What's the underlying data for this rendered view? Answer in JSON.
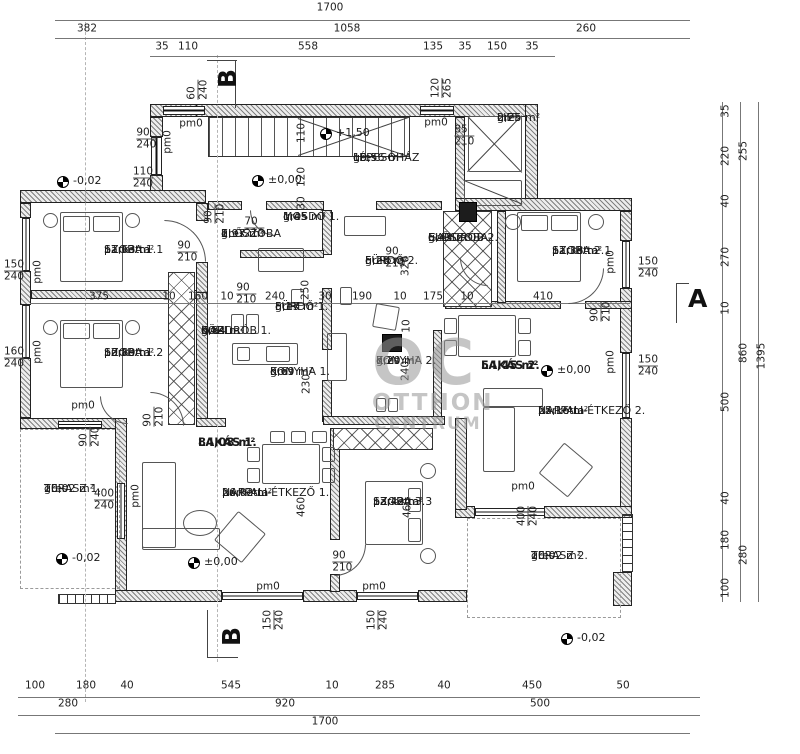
{
  "watermark": {
    "big": "OC",
    "line1": "OTTHON",
    "line2": "CENTRUM"
  },
  "rooms": [
    {
      "name": "LÉPCSŐHÁZ",
      "mat": "gres",
      "area": "19,56 m²",
      "x": 353,
      "y": 152
    },
    {
      "name": "LIFT",
      "mat": "gres",
      "area": "2,25 m²",
      "x": 497,
      "y": 112
    },
    {
      "name": "SZOBA 1.1",
      "mat": "parketta",
      "area": "11,63 m²",
      "x": 104,
      "y": 244
    },
    {
      "name": "SZOBA 1.2",
      "mat": "parketta",
      "area": "10,89 m²",
      "x": 104,
      "y": 347
    },
    {
      "name": "ELŐSZOBA",
      "n2": "1.",
      "mat": "gres",
      "area": "2,97 m²",
      "x": 221,
      "y": 228
    },
    {
      "name": "MOSDÓ 1.",
      "mat": "gres",
      "area": "1,45 m²",
      "x": 283,
      "y": 211
    },
    {
      "name": "FÜRDŐ 2.",
      "mat": "gres",
      "area": "5,28 m²",
      "x": 365,
      "y": 255
    },
    {
      "name": "ELŐSZOBA-",
      "n2": "GARDRÓB 2.",
      "mat": "gres",
      "area": "5,43 m²",
      "x": 428,
      "y": 232
    },
    {
      "name": "SZOBA 2.1",
      "mat": "parketta",
      "area": "11,38 m²",
      "x": 552,
      "y": 245
    },
    {
      "name": "KÖZL.-",
      "n2": "GARDRÓB 1.",
      "mat": "gres",
      "area": "6,84 m²",
      "x": 201,
      "y": 325
    },
    {
      "name": "FÜRDŐ 1.",
      "mat": "gres",
      "area": "5,17 m²",
      "x": 275,
      "y": 301
    },
    {
      "name": "KONYHA 1.",
      "mat": "gres",
      "area": "5,69 m²",
      "x": 270,
      "y": 366
    },
    {
      "name": "KONYHA 2.",
      "mat": "gres",
      "area": "7,20 m²",
      "x": 376,
      "y": 355
    },
    {
      "name": "LAKÁS 2.",
      "area": "54,45 m²",
      "bold": true,
      "x": 481,
      "y": 359
    },
    {
      "name": "NAPPALI-ÉTKEZŐ 2.",
      "mat": "parketta",
      "area": "25,16 m²",
      "x": 538,
      "y": 405
    },
    {
      "name": "TERASZ 1.",
      "mat": "gres",
      "area": "20,02 m²",
      "x": 44,
      "y": 483
    },
    {
      "name": "LAKÁS 1.",
      "area": "84,08 m²",
      "bold": true,
      "x": 198,
      "y": 436
    },
    {
      "name": "NAPPALI-ÉTKEZŐ 1.",
      "mat": "parketta",
      "area": "26,02 m²",
      "x": 222,
      "y": 487
    },
    {
      "name": "SZOBA 3.3",
      "mat": "parketta",
      "area": "13,42 m²",
      "x": 373,
      "y": 496
    },
    {
      "name": "TERASZ 2.",
      "mat": "gres",
      "area": "20,02 m²",
      "x": 531,
      "y": 550
    }
  ],
  "levels": [
    {
      "v": "-0,02",
      "x": 57,
      "y": 176
    },
    {
      "v": "+1,50",
      "x": 320,
      "y": 128
    },
    {
      "v": "±0,00",
      "x": 252,
      "y": 175
    },
    {
      "v": "±0,00",
      "x": 541,
      "y": 365
    },
    {
      "v": "±0,00",
      "x": 188,
      "y": 557
    },
    {
      "v": "-0,02",
      "x": 56,
      "y": 553
    },
    {
      "v": "-0,02",
      "x": 561,
      "y": 633
    }
  ],
  "sections": [
    {
      "t": "B",
      "x": 218,
      "y": 80,
      "rot": true
    },
    {
      "t": "B",
      "x": 222,
      "y": 638,
      "rot": true
    },
    {
      "t": "A",
      "x": 688,
      "y": 300,
      "rot": false
    }
  ],
  "dims": [
    [
      "1700",
      330,
      8
    ],
    [
      "382",
      87,
      29
    ],
    [
      "1058",
      347,
      29
    ],
    [
      "260",
      586,
      29
    ],
    [
      "35",
      162,
      47
    ],
    [
      "110",
      188,
      47
    ],
    [
      "558",
      308,
      47
    ],
    [
      "135",
      433,
      47
    ],
    [
      "35",
      465,
      47
    ],
    [
      "150",
      497,
      47
    ],
    [
      "35",
      532,
      47
    ],
    [
      "35",
      726,
      111,
      1
    ],
    [
      "220",
      726,
      156,
      1
    ],
    [
      "40",
      726,
      201,
      1
    ],
    [
      "270",
      726,
      257,
      1
    ],
    [
      "10",
      726,
      308,
      1
    ],
    [
      "500",
      726,
      402,
      1
    ],
    [
      "40",
      726,
      498,
      1
    ],
    [
      "180",
      726,
      540,
      1
    ],
    [
      "100",
      726,
      588,
      1
    ],
    [
      "255",
      744,
      151,
      1
    ],
    [
      "860",
      744,
      353,
      1
    ],
    [
      "280",
      744,
      555,
      1
    ],
    [
      "1395",
      762,
      356,
      1
    ],
    [
      "100",
      35,
      686
    ],
    [
      "180",
      86,
      686
    ],
    [
      "40",
      127,
      686
    ],
    [
      "545",
      231,
      686
    ],
    [
      "10",
      332,
      686
    ],
    [
      "285",
      385,
      686
    ],
    [
      "40",
      444,
      686
    ],
    [
      "450",
      532,
      686
    ],
    [
      "50",
      623,
      686
    ],
    [
      "280",
      68,
      704
    ],
    [
      "920",
      285,
      704
    ],
    [
      "500",
      540,
      704
    ],
    [
      "1700",
      325,
      722
    ],
    [
      "375",
      99,
      297
    ],
    [
      "10",
      169,
      297
    ],
    [
      "160",
      198,
      297
    ],
    [
      "10",
      227,
      297
    ],
    [
      "240",
      275,
      297
    ],
    [
      "30",
      325,
      297
    ],
    [
      "190",
      362,
      297
    ],
    [
      "10",
      400,
      297
    ],
    [
      "175",
      433,
      297
    ],
    [
      "10",
      467,
      297
    ],
    [
      "410",
      543,
      297
    ],
    [
      "250",
      306,
      290,
      1
    ],
    [
      "320",
      406,
      266,
      1
    ],
    [
      "110",
      302,
      133,
      1
    ],
    [
      "120",
      302,
      177,
      1
    ],
    [
      "30",
      302,
      203,
      1
    ],
    [
      "230",
      307,
      384,
      1
    ],
    [
      "240",
      406,
      371,
      1
    ],
    [
      "10",
      407,
      326,
      1
    ],
    [
      "460",
      302,
      507,
      1
    ],
    [
      "460",
      408,
      508,
      1
    ],
    [
      "90",
      143,
      133,
      0,
      "240"
    ],
    [
      "110",
      143,
      172,
      0,
      "240"
    ],
    [
      "85",
      461,
      130,
      0,
      "210"
    ],
    [
      "70",
      251,
      222,
      0,
      "210"
    ],
    [
      "90",
      184,
      246,
      0,
      "210"
    ],
    [
      "90",
      243,
      288,
      0,
      "210"
    ],
    [
      "90",
      392,
      252,
      0,
      "210"
    ],
    [
      "60",
      192,
      93,
      1,
      "240"
    ],
    [
      "90",
      209,
      217,
      1,
      "210"
    ],
    [
      "120",
      436,
      88,
      1,
      "265"
    ],
    [
      "90",
      595,
      315,
      1,
      "210"
    ],
    [
      "90",
      148,
      420,
      1,
      "210"
    ],
    [
      "90",
      84,
      440,
      1,
      "240"
    ],
    [
      "150",
      14,
      265,
      0,
      "240"
    ],
    [
      "160",
      14,
      352,
      0,
      "240"
    ],
    [
      "400",
      104,
      494,
      0,
      "240"
    ],
    [
      "90",
      339,
      556,
      0,
      "210"
    ],
    [
      "400",
      522,
      516,
      1,
      "240"
    ],
    [
      "150",
      268,
      620,
      1,
      "240"
    ],
    [
      "150",
      372,
      620,
      1,
      "240"
    ],
    [
      "150",
      648,
      262,
      0,
      "240"
    ],
    [
      "150",
      648,
      360,
      0,
      "240"
    ],
    [
      "pm0",
      191,
      124
    ],
    [
      "pm0",
      436,
      123
    ],
    [
      "pm0",
      268,
      587
    ],
    [
      "pm0",
      374,
      587
    ],
    [
      "pm0",
      523,
      487
    ],
    [
      "pm0",
      83,
      406
    ],
    [
      "pm0",
      38,
      272,
      1
    ],
    [
      "pm0",
      38,
      352,
      1
    ],
    [
      "pm0",
      168,
      142,
      1
    ],
    [
      "pm0",
      611,
      262,
      1
    ],
    [
      "pm0",
      611,
      362,
      1
    ],
    [
      "pm0",
      136,
      496,
      1
    ]
  ],
  "plan": {
    "walls": [
      [
        150,
        104,
        58,
        13
      ],
      [
        196,
        104,
        342,
        13
      ],
      [
        525,
        104,
        13,
        107
      ],
      [
        455,
        117,
        10,
        82
      ],
      [
        455,
        198,
        177,
        13
      ],
      [
        620,
        211,
        12,
        30
      ],
      [
        620,
        288,
        12,
        65
      ],
      [
        620,
        418,
        12,
        100
      ],
      [
        544,
        506,
        88,
        12
      ],
      [
        455,
        506,
        20,
        12
      ],
      [
        150,
        117,
        13,
        20
      ],
      [
        150,
        175,
        13,
        22
      ],
      [
        20,
        190,
        186,
        13
      ],
      [
        20,
        203,
        11,
        15
      ],
      [
        20,
        271,
        11,
        34
      ],
      [
        20,
        358,
        11,
        60
      ],
      [
        20,
        418,
        100,
        11
      ],
      [
        115,
        418,
        12,
        184
      ],
      [
        115,
        590,
        107,
        12
      ],
      [
        303,
        590,
        54,
        12
      ],
      [
        418,
        590,
        49,
        12
      ],
      [
        455,
        418,
        12,
        92
      ],
      [
        613,
        572,
        19,
        34
      ],
      [
        196,
        203,
        12,
        18
      ],
      [
        196,
        262,
        12,
        32
      ],
      [
        196,
        292,
        12,
        133
      ],
      [
        31,
        290,
        166,
        9
      ],
      [
        208,
        201,
        34,
        9
      ],
      [
        266,
        201,
        58,
        9
      ],
      [
        376,
        201,
        66,
        9
      ],
      [
        322,
        210,
        10,
        45
      ],
      [
        322,
        288,
        10,
        62
      ],
      [
        322,
        380,
        10,
        42
      ],
      [
        240,
        250,
        84,
        8
      ],
      [
        445,
        301,
        116,
        8
      ],
      [
        585,
        301,
        47,
        8
      ],
      [
        497,
        211,
        9,
        92
      ],
      [
        433,
        330,
        9,
        88
      ],
      [
        323,
        416,
        122,
        9
      ],
      [
        196,
        418,
        30,
        9
      ],
      [
        330,
        428,
        10,
        112
      ],
      [
        330,
        574,
        10,
        18
      ]
    ],
    "xh": [
      [
        168,
        272,
        27,
        153
      ],
      [
        443,
        211,
        49,
        96
      ],
      [
        333,
        428,
        100,
        22
      ]
    ],
    "stairs": [
      [
        208,
        117,
        202,
        40
      ]
    ],
    "wins": [
      [
        151,
        137,
        11,
        38,
        "v"
      ],
      [
        163,
        106,
        42,
        9,
        "h"
      ],
      [
        420,
        106,
        34,
        9,
        "h"
      ],
      [
        22,
        218,
        8,
        53,
        "v"
      ],
      [
        22,
        305,
        8,
        53,
        "v"
      ],
      [
        622,
        241,
        8,
        47,
        "v"
      ],
      [
        622,
        353,
        8,
        65,
        "v"
      ],
      [
        475,
        508,
        70,
        8,
        "h"
      ],
      [
        222,
        592,
        81,
        8,
        "h"
      ],
      [
        357,
        592,
        61,
        8,
        "h"
      ],
      [
        58,
        421,
        44,
        7,
        "h"
      ],
      [
        117,
        483,
        8,
        56,
        "v"
      ]
    ],
    "ladder": [
      [
        58,
        594,
        58,
        10,
        "h"
      ],
      [
        622,
        514,
        11,
        58,
        "v"
      ]
    ],
    "dash": [
      [
        20,
        429,
        100,
        160
      ],
      [
        467,
        518,
        154,
        100
      ]
    ],
    "axisv": [
      [
        217,
        55,
        607
      ],
      [
        85,
        22,
        680
      ]
    ],
    "dl": [
      [
        55,
        20,
        635,
        "h"
      ],
      [
        55,
        38,
        635,
        "h"
      ],
      [
        150,
        56,
        405,
        "h"
      ],
      [
        30,
        303,
        600,
        "h"
      ],
      [
        18,
        697,
        682,
        "h"
      ],
      [
        18,
        715,
        682,
        "h"
      ],
      [
        55,
        733,
        635,
        "h"
      ],
      [
        722,
        102,
        500,
        "v"
      ],
      [
        740,
        102,
        500,
        "v"
      ],
      [
        758,
        102,
        500,
        "v"
      ]
    ],
    "lines": [
      [
        468,
        116,
        78,
        46
      ],
      [
        522,
        116,
        78,
        134
      ],
      [
        464,
        180,
        63,
        22
      ],
      [
        298,
        155,
        118,
        -19
      ],
      [
        298,
        118,
        118,
        19
      ],
      [
        207,
        60,
        30,
        0
      ],
      [
        236,
        60,
        48,
        90
      ],
      [
        208,
        657,
        30,
        0
      ],
      [
        208,
        610,
        48,
        90
      ],
      [
        677,
        283,
        12,
        0
      ],
      [
        677,
        283,
        40,
        90
      ]
    ],
    "fur": [
      [
        60,
        212,
        63,
        70,
        0
      ],
      [
        63,
        216,
        27,
        16,
        0
      ],
      [
        93,
        216,
        27,
        16,
        0
      ],
      [
        60,
        320,
        63,
        68,
        0
      ],
      [
        63,
        323,
        27,
        16,
        0
      ],
      [
        93,
        323,
        27,
        16,
        0
      ],
      [
        517,
        212,
        64,
        70,
        0
      ],
      [
        521,
        215,
        27,
        16,
        0
      ],
      [
        551,
        215,
        27,
        16,
        0
      ],
      [
        365,
        481,
        58,
        64,
        0
      ],
      [
        408,
        488,
        13,
        24,
        0
      ],
      [
        408,
        518,
        13,
        24,
        0
      ],
      [
        262,
        444,
        58,
        40,
        0
      ],
      [
        247,
        447,
        13,
        15,
        0
      ],
      [
        247,
        468,
        13,
        15,
        0
      ],
      [
        322,
        447,
        13,
        15,
        0
      ],
      [
        322,
        468,
        13,
        15,
        0
      ],
      [
        270,
        431,
        15,
        12,
        0
      ],
      [
        291,
        431,
        15,
        12,
        0
      ],
      [
        312,
        431,
        15,
        12,
        0
      ],
      [
        458,
        315,
        58,
        42,
        0
      ],
      [
        444,
        318,
        13,
        16,
        0
      ],
      [
        444,
        340,
        13,
        16,
        0
      ],
      [
        518,
        318,
        13,
        16,
        0
      ],
      [
        518,
        340,
        13,
        16,
        0
      ],
      [
        142,
        462,
        34,
        86,
        0
      ],
      [
        142,
        528,
        78,
        22,
        0
      ],
      [
        222,
        518,
        36,
        38,
        40
      ],
      [
        483,
        388,
        60,
        19,
        0
      ],
      [
        483,
        407,
        32,
        65,
        0
      ],
      [
        547,
        450,
        38,
        40,
        40
      ],
      [
        232,
        343,
        66,
        22,
        0
      ],
      [
        237,
        347,
        13,
        14,
        0
      ],
      [
        266,
        346,
        24,
        16,
        0
      ],
      [
        327,
        333,
        20,
        48,
        0
      ],
      [
        376,
        398,
        10,
        14,
        0
      ],
      [
        388,
        398,
        10,
        14,
        0
      ],
      [
        344,
        216,
        42,
        20,
        0
      ],
      [
        258,
        248,
        46,
        24,
        0
      ],
      [
        374,
        305,
        24,
        24,
        10
      ],
      [
        291,
        289,
        13,
        17,
        0
      ],
      [
        340,
        287,
        12,
        18,
        0
      ],
      [
        231,
        314,
        13,
        20,
        0
      ],
      [
        246,
        314,
        13,
        20,
        0
      ],
      [
        468,
        116,
        54,
        56,
        0
      ],
      [
        464,
        180,
        58,
        26,
        0
      ]
    ],
    "circ": [
      [
        43,
        213,
        15,
        15
      ],
      [
        125,
        213,
        15,
        15
      ],
      [
        43,
        320,
        15,
        15
      ],
      [
        125,
        320,
        15,
        15
      ],
      [
        505,
        214,
        16,
        16
      ],
      [
        588,
        214,
        16,
        16
      ],
      [
        420,
        463,
        16,
        16
      ],
      [
        420,
        548,
        16,
        16
      ],
      [
        183,
        510,
        34,
        26
      ]
    ],
    "dark": [
      [
        459,
        202,
        18,
        20
      ],
      [
        382,
        334,
        20,
        18
      ]
    ],
    "arcs": [
      [
        164,
        220,
        42,
        "tr"
      ],
      [
        250,
        210,
        26,
        "bl"
      ],
      [
        150,
        392,
        34,
        "tr"
      ],
      [
        568,
        268,
        36,
        "br"
      ],
      [
        334,
        544,
        32,
        "br"
      ],
      [
        100,
        396,
        28,
        "bl"
      ],
      [
        460,
        258,
        28,
        "bl"
      ]
    ]
  }
}
